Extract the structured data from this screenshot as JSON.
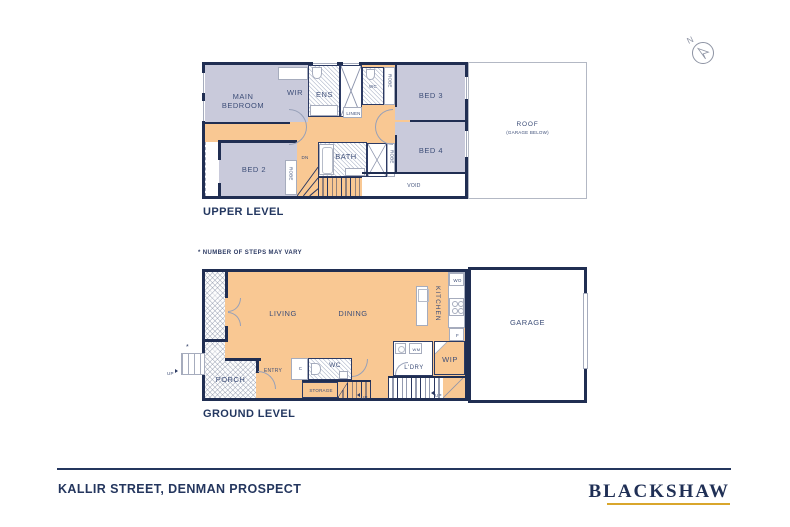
{
  "north": {
    "n": "N"
  },
  "icons": {
    "north_arrow": "north-arrow-icon",
    "up_marker": "triangle-arrow",
    "down_marker": "DN"
  },
  "upper": {
    "title": "UPPER LEVEL",
    "labels": {
      "main_bedroom": "MAIN BEDROOM",
      "wir": "WIR",
      "ens": "ENS",
      "wc": "WC",
      "robe": "ROBE",
      "bed3": "BED 3",
      "linen": "LINEN",
      "bed2": "BED 2",
      "bath": "BATH",
      "bed4": "BED 4",
      "void": "VOID",
      "dn": "DN",
      "roof": "ROOF",
      "roof_sub": "(GARAGE BELOW)"
    }
  },
  "ground": {
    "title": "GROUND LEVEL",
    "note": "* NUMBER OF STEPS MAY VARY",
    "labels": {
      "living": "LIVING",
      "dining": "DINING",
      "kitchen": "KITCHEN",
      "wo": "WO",
      "f": "F",
      "wip": "WIP",
      "ldry": "L'DRY",
      "wm": "WM",
      "wc": "WC",
      "c": "C",
      "entry": "ENTRY",
      "porch": "PORCH",
      "storage": "STORAGE",
      "garage": "GARAGE",
      "up": "UP",
      "asterisk": "*"
    }
  },
  "footer": {
    "address": "KALLIR STREET, DENMAN PROSPECT",
    "brand": "BLACKSHAW"
  },
  "colors": {
    "wall_navy": "#202e52",
    "room_lavender": "#c9cadb",
    "hall_orange": "#f9c893",
    "brand_navy": "#1f2f55",
    "brand_gold": "#d9a62c"
  }
}
